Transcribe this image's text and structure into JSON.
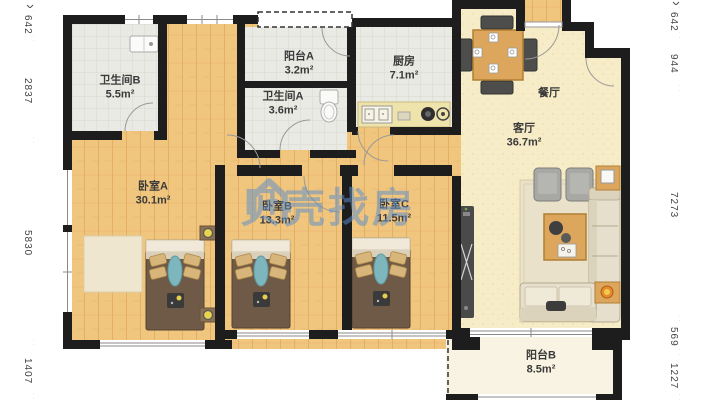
{
  "watermark": {
    "brand": "贝壳找房",
    "color": "#5b8fcc"
  },
  "rooms": [
    {
      "id": "bathroom-b",
      "name": "卫生间B",
      "area": "5.5m²"
    },
    {
      "id": "balcony-a",
      "name": "阳台A",
      "area": "3.2m²"
    },
    {
      "id": "bathroom-a",
      "name": "卫生间A",
      "area": "3.6m²"
    },
    {
      "id": "kitchen",
      "name": "厨房",
      "area": "7.1m²"
    },
    {
      "id": "dining",
      "name": "餐厅",
      "area": ""
    },
    {
      "id": "living",
      "name": "客厅",
      "area": "36.7m²"
    },
    {
      "id": "bedroom-a",
      "name": "卧室A",
      "area": "30.1m²"
    },
    {
      "id": "bedroom-b",
      "name": "卧室B",
      "area": "13.3m²"
    },
    {
      "id": "bedroom-c",
      "name": "卧室C",
      "area": "11.5m²"
    },
    {
      "id": "balcony-b",
      "name": "阳台B",
      "area": "8.5m²"
    }
  ],
  "dimensions": {
    "left": [
      "642",
      "2837",
      "5830",
      "1407"
    ],
    "right": [
      "642",
      "944",
      "7273",
      "569",
      "1227"
    ]
  },
  "colors": {
    "wall": "#1d1d1d",
    "wood_floor": "#f0c57e",
    "living_floor": "#f7ecc8",
    "tile_floor": "#eaeae5",
    "balcony_floor": "#f8f3e2",
    "watermark_blue": "#5b8fcc"
  }
}
